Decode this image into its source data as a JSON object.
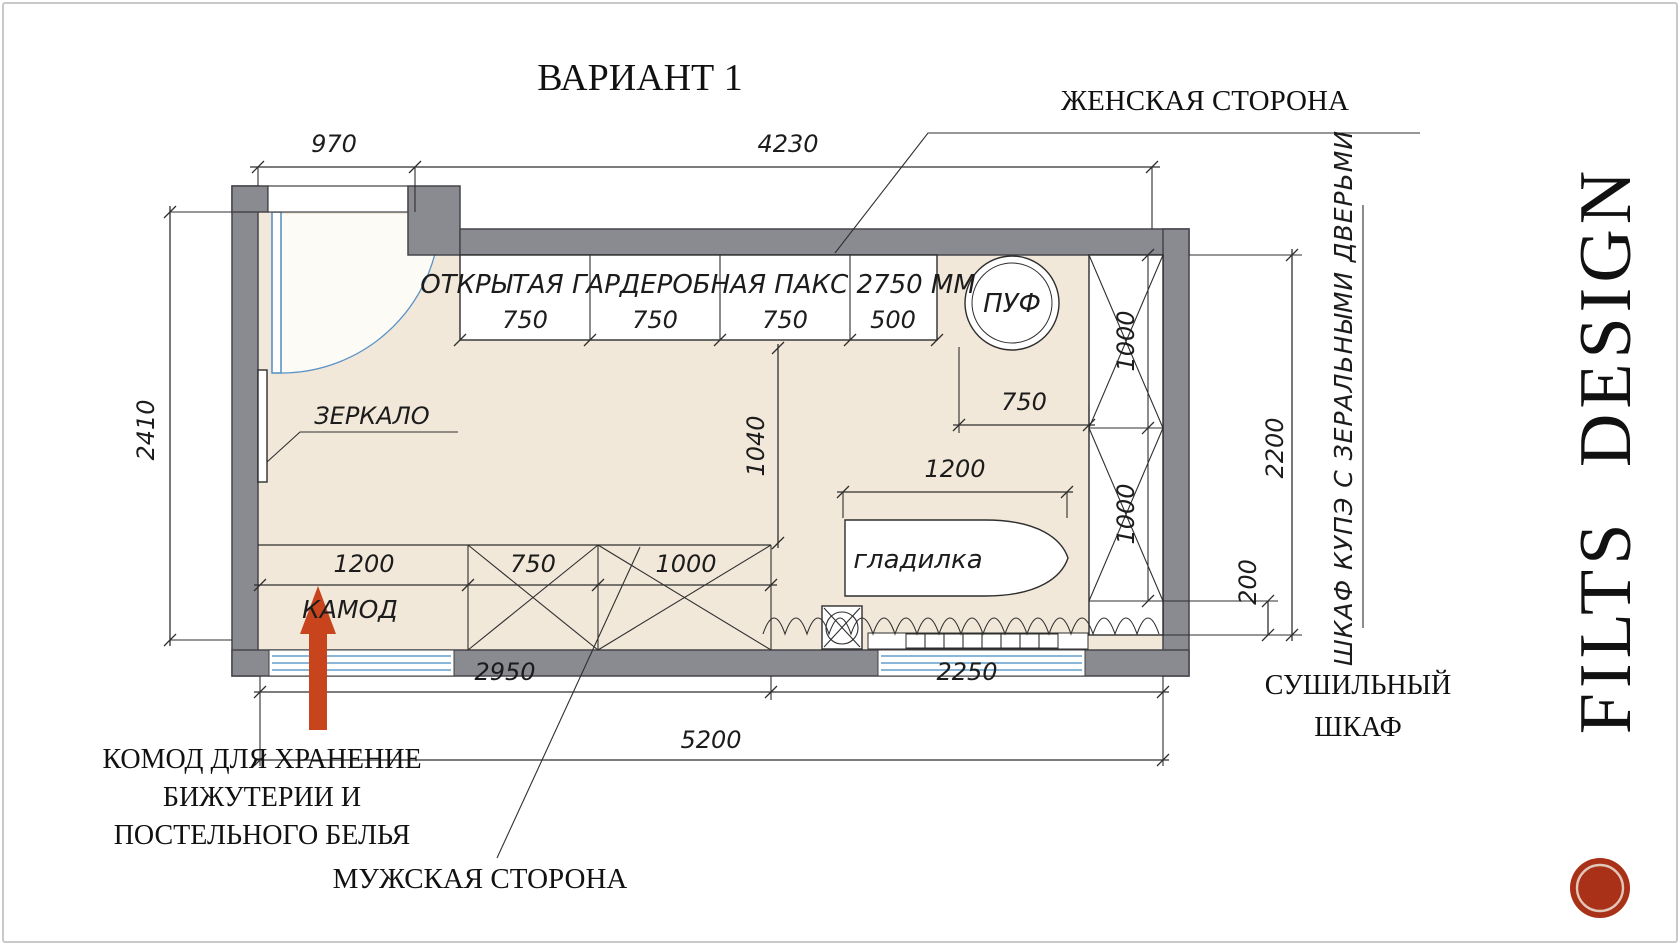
{
  "slide": {
    "title": "ВАРИАНТ 1",
    "brand_vertical": "FILTS DESIGN"
  },
  "annotations": {
    "female_side": "ЖЕНСКАЯ СТОРОНА",
    "male_side": "МУЖСКАЯ СТОРОНА",
    "commode_note": [
      "КОМОД ДЛЯ ХРАНЕНИЕ",
      "БИЖУТЕРИИ И",
      "ПОСТЕЛЬНОГО БЕЛЬЯ"
    ],
    "drying_cabinet": [
      "СУШИЛЬНЫЙ",
      "ШКАФ"
    ],
    "sliding_wardrobe": "ШКАФ КУПЭ С ЗЕРАЛЬНЫМИ ДВЕРЬМИ"
  },
  "furniture_labels": {
    "open_wardrobe": "ОТКРЫТАЯ ГАРДЕРОБНАЯ ПАКС 2750 ММ",
    "pouf": "ПУФ",
    "mirror": "ЗЕРКАЛО",
    "ironing_board": "гладилка",
    "commode": "КАМОД"
  },
  "dimensions_mm": {
    "door_opening": "970",
    "top_span": "4230",
    "room_depth": "2410",
    "paks_sections": [
      "750",
      "750",
      "750",
      "500"
    ],
    "pouf_zone": "750",
    "passage": "1040",
    "ironing_board": "1200",
    "commode": "1200",
    "mens_mid": "750",
    "mens_right": "1000",
    "wardrobe_upper": "1000",
    "wardrobe_lower": "1000",
    "wardrobe_length": "2200",
    "wardrobe_offset": "200",
    "bottom_left_span": "2950",
    "bottom_right_span": "2250",
    "bottom_total": "5200"
  },
  "colors": {
    "wall": "#8a8a91",
    "floor": "#f1e8d9",
    "door": "#5b93c7",
    "accent_arrow": "#c8441c",
    "stamp": "#a93117",
    "line": "#2f2f2f"
  }
}
